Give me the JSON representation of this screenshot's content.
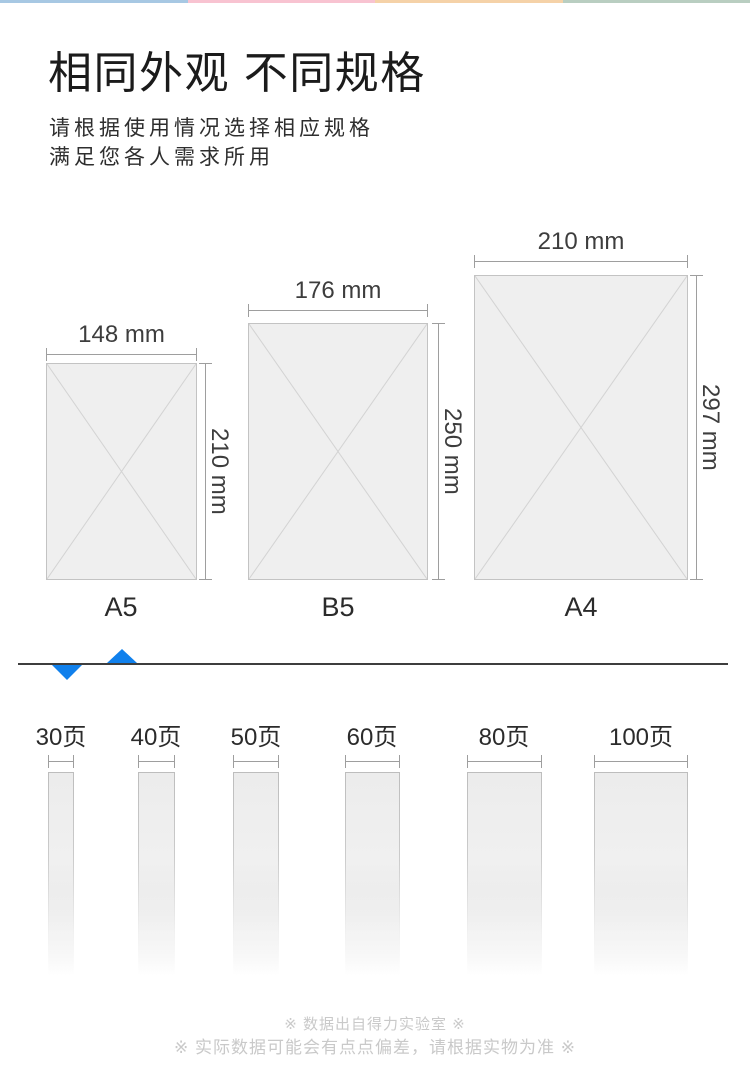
{
  "header": {
    "title": "相同外观 不同规格",
    "subtitle_lines": [
      "请根据使用情况选择相应规格",
      "满足您各人需求所用"
    ]
  },
  "accent_strip": {
    "colors": [
      "#a7c8e3",
      "#f8c3d1",
      "#f5d2a8",
      "#b9cec1"
    ]
  },
  "paper_sizes": [
    {
      "name": "A5",
      "width_label": "148 mm",
      "height_label": "210 mm"
    },
    {
      "name": "B5",
      "width_label": "176 mm",
      "height_label": "250 mm"
    },
    {
      "name": "A4",
      "width_label": "210 mm",
      "height_label": "297 mm"
    }
  ],
  "divider": {
    "triangle_color": "#1080ec"
  },
  "page_count_options": [
    {
      "label": "30页"
    },
    {
      "label": "40页"
    },
    {
      "label": "50页"
    },
    {
      "label": "60页"
    },
    {
      "label": "80页"
    },
    {
      "label": "100页"
    }
  ],
  "footer": {
    "note1": "※ 数据出自得力实验室 ※",
    "note2": "※ 实际数据可能会有点点偏差，请根据实物为准 ※"
  }
}
